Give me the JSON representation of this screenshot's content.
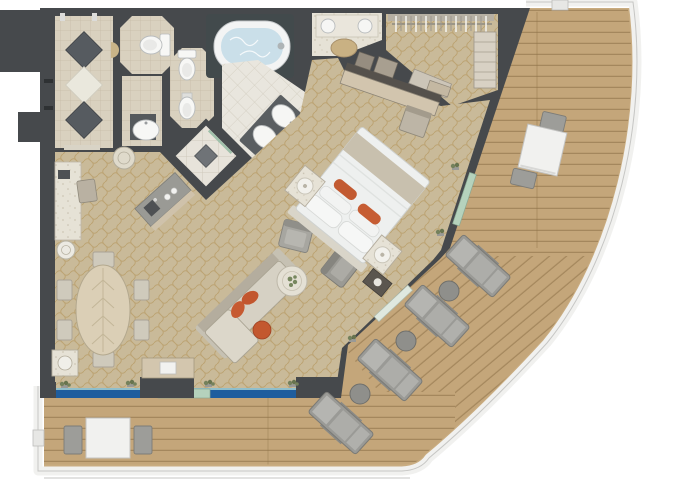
{
  "plan": {
    "title": "Luxury suite floor plan with curved private veranda",
    "rooms": [
      {
        "id": "entry-hall",
        "name": "Entry hall with diamond inlay floor"
      },
      {
        "id": "guest-wc",
        "name": "Guest WC"
      },
      {
        "id": "wc-bidet",
        "name": "WC with bidet"
      },
      {
        "id": "bathtub-alcove",
        "name": "Spa bathtub alcove"
      },
      {
        "id": "bathroom",
        "name": "Master bathroom with twin basins"
      },
      {
        "id": "shower-room",
        "name": "Walk-in shower with floor drain"
      },
      {
        "id": "wet-bar",
        "name": "Wet bar / pantry counter"
      },
      {
        "id": "dressing-area",
        "name": "Dressing vanity with stool"
      },
      {
        "id": "walk-in-closet",
        "name": "Walk-in closet with hanging rods and shelves"
      },
      {
        "id": "bedroom",
        "name": "Bedroom with king bed"
      },
      {
        "id": "living-dining",
        "name": "Living and dining room"
      },
      {
        "id": "veranda",
        "name": "Curved teak veranda deck"
      }
    ],
    "furniture": {
      "living_dining": [
        "oval dining table",
        "6 dining chairs",
        "writing desk with phone",
        "desk chair",
        "round side table",
        "sofa with chaise",
        "2 orange accent pillows",
        "orange pouf",
        "round marble coffee table with greenery",
        "2 armchairs",
        "side cabinet with lamp",
        "console table with TV",
        "square plant table"
      ],
      "bedroom": [
        "king bed with white duvet and 2 orange pillows",
        "2 nightstands with lamps",
        "built-in desk with storage boxes",
        "desk chair",
        "media cabinet"
      ],
      "bath_block": [
        "oval jacuzzi tub",
        "2 toilets",
        "bidet",
        "pedestal basin",
        "double-sink vanity",
        "walk-in shower",
        "vanity with 2 bowls and stool"
      ],
      "deck": [
        "2 white dining tables with 2 chairs each",
        "4 sun loungers",
        "3 round side tables"
      ]
    },
    "counts": {
      "dining_chairs": 6,
      "sun_loungers": 4,
      "lounger_side_tables": 3,
      "deck_table_sets": 2,
      "toilets": 2,
      "bidets": 1,
      "wash_basins": 3,
      "armchairs": 2,
      "table_lamps": 2
    },
    "colors": {
      "wall": "#46494c",
      "carpet": "#c9ba99",
      "carpet_lattice": "#b08f52",
      "deck_wood": "#c4a67a",
      "plank_line": "#8f7348",
      "railing": "#f1f1ef",
      "window_blue": "#1e5d9e",
      "glass_green": "#b5d2bc",
      "beige_tile": "#d9d1bf",
      "bath_tile": "#e9e6de",
      "marble": "#e6e2d6",
      "accent_orange": "#c2562e",
      "tub_water": "#cadfe9",
      "furniture_gray": "#a3a29c",
      "wood_light": "#d5c8ae"
    }
  }
}
